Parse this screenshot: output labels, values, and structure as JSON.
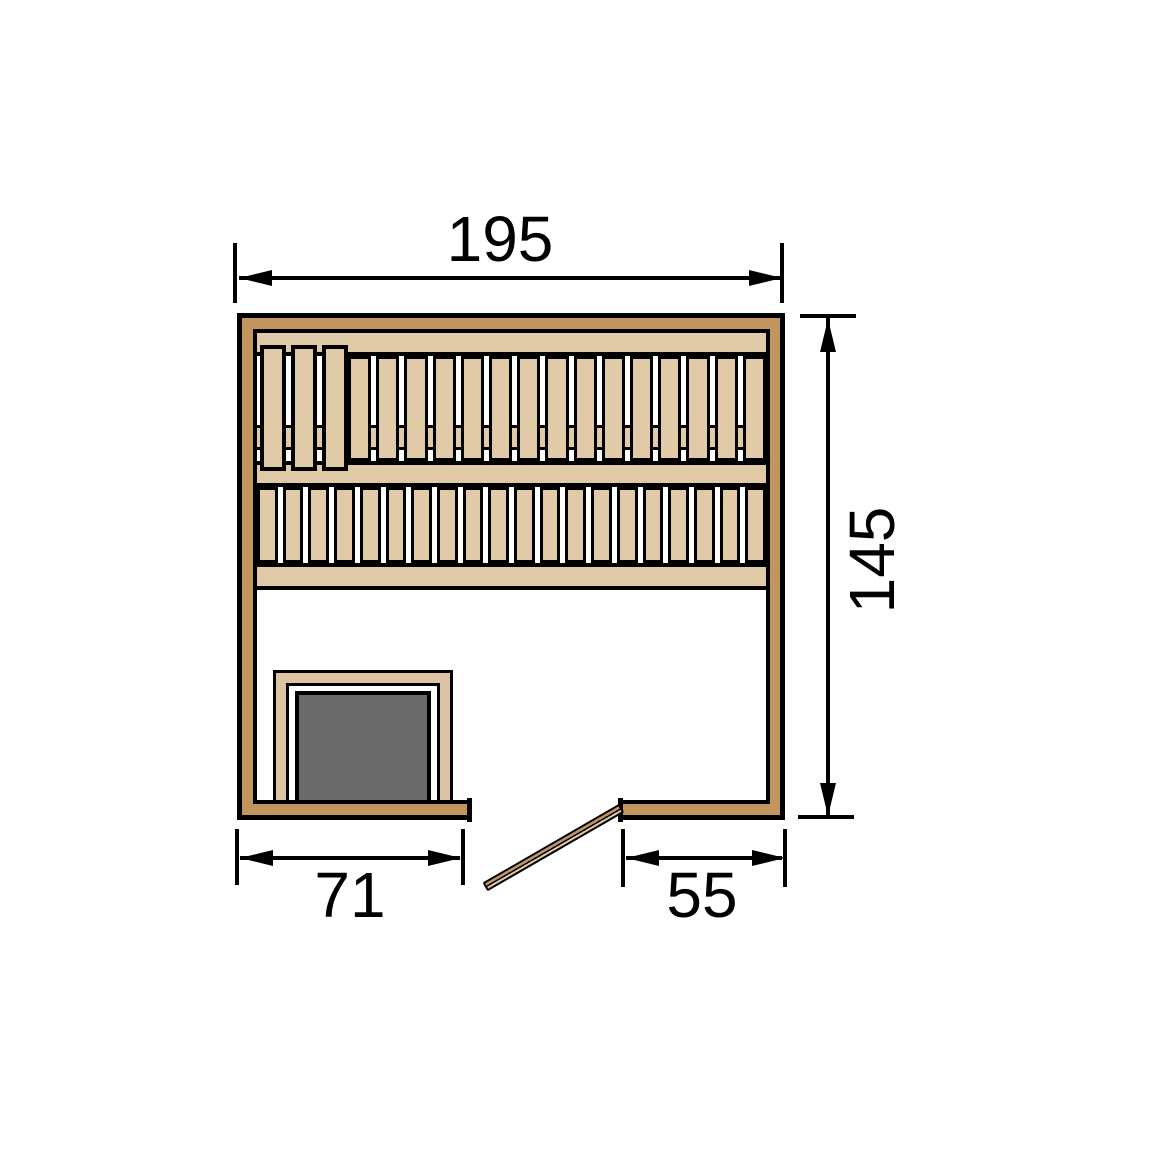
{
  "labels": {
    "total_width": "195",
    "total_depth": "145",
    "heater_side_width": "71",
    "entry_side_width": "55"
  },
  "sauna": {
    "backrest_board_count": 3,
    "bench_top_slat_count": 15,
    "bench_front_slat_count": 20
  },
  "colors": {
    "background": "#ffffff",
    "outline": "#000000",
    "wall_wood": "#c2945e",
    "bench_wood": "#e0caa8",
    "heater_frame_wood": "#dcc4a2",
    "heater_body": "#6a6a6a",
    "door_wood": "#c2945e",
    "dimension_text": "#000000"
  }
}
